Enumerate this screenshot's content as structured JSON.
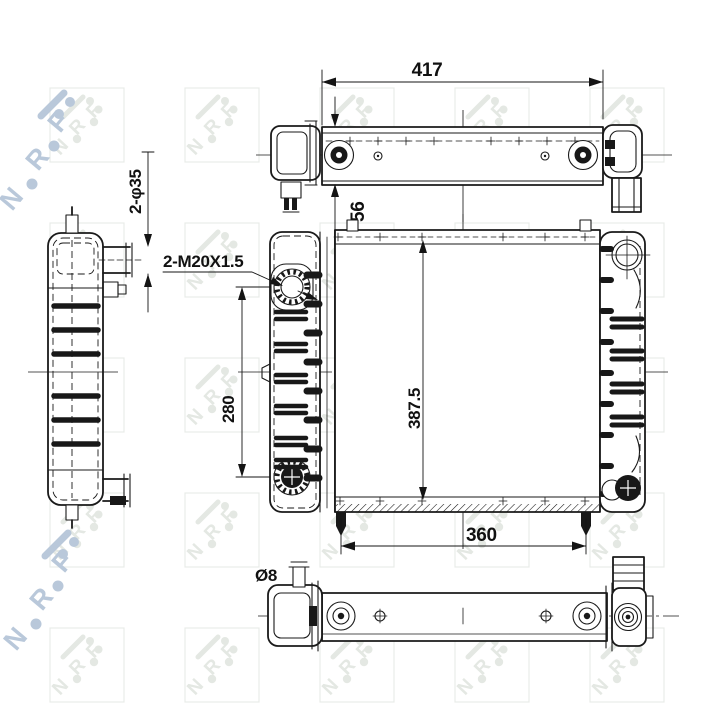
{
  "drawing": {
    "brand": "NRF",
    "dimensions": {
      "top_width": "417",
      "tank_depth": "56",
      "inlet_pipes": "2-φ35",
      "ports_thread": "2-M20X1.5",
      "ports_spacing": "280",
      "core_height": "387.5",
      "pins_spacing": "360",
      "pin_diameter": "Ø8"
    },
    "watermark": {
      "letters": [
        "N",
        "R",
        "F"
      ]
    },
    "colors": {
      "background": "#ffffff",
      "line": "#1a1a1a",
      "watermark_tile": "#e4e8e3",
      "watermark_logo": "#b9c8da"
    }
  }
}
